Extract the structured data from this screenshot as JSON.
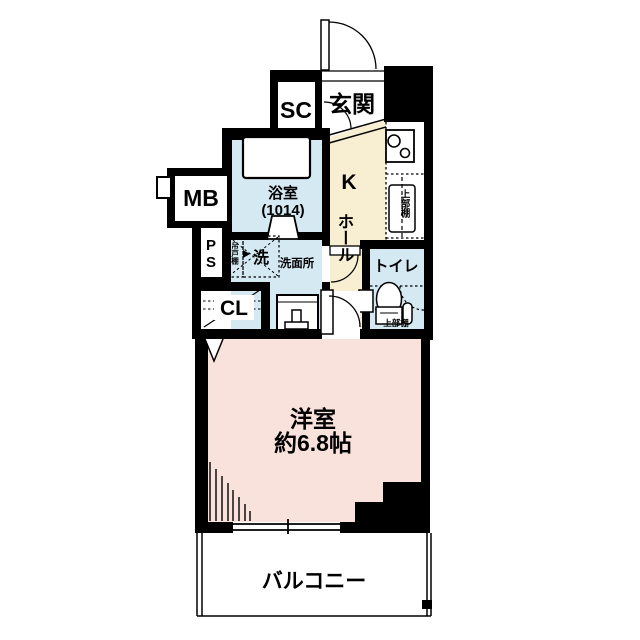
{
  "floor_plan": {
    "rooms": {
      "shoe_closet": "SC",
      "entrance": "玄関",
      "meter_box": "MB",
      "bathroom": "浴室",
      "bathroom_size": "(1014)",
      "kitchen": "K",
      "hall": "ホール",
      "upper_shelf_kitchen": "上部棚",
      "pipe_space": "PS",
      "hanging_cupboard": "吊戸棚",
      "washer": "洗",
      "washroom": "洗面所",
      "closet": "CL",
      "toilet": "トイレ",
      "upper_shelf_toilet": "上部棚",
      "main_room": "洋室",
      "main_room_size": "約6.8帖",
      "balcony": "バルコニー"
    },
    "colors": {
      "background": "#ffffff",
      "wall": "#000000",
      "main_room_fill": "#f8e2db",
      "kitchen_hall_fill": "#f8efd2",
      "wet_area_fill": "#d5e9f3"
    }
  }
}
